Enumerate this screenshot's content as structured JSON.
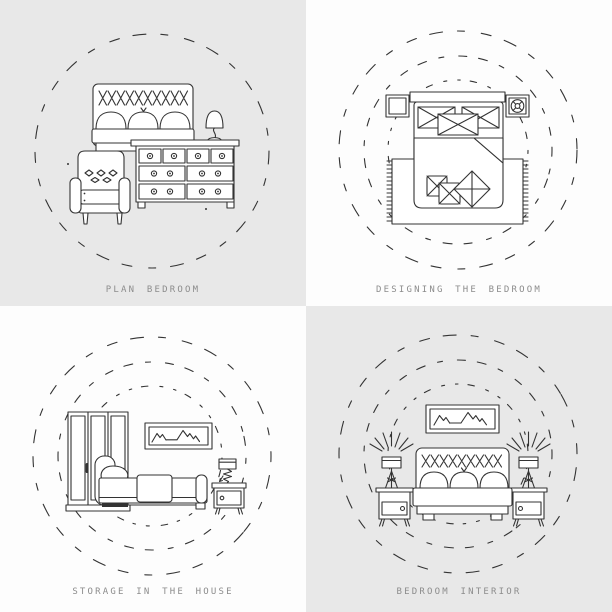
{
  "palette": {
    "quadrant_gray": "#e8e8e8",
    "quadrant_white": "#fdfdfd",
    "line_color": "#333333",
    "caption_color": "#8c8c8c"
  },
  "panels": [
    {
      "caption": "PLAN BEDROOM",
      "background": "gray",
      "dashed_circles": 1,
      "icons": [
        "double-bed-icon",
        "tufted-headboard-icon",
        "pillow-icon",
        "armchair-icon",
        "dresser-icon",
        "table-lamp-icon"
      ]
    },
    {
      "caption": "DESIGNING THE BEDROOM",
      "background": "white",
      "dashed_circles": 3,
      "icons": [
        "bed-top-view-icon",
        "headboard-bar-icon",
        "bedside-table-icon",
        "plant-on-table-icon",
        "folded-blanket-icon",
        "rug-with-fringe-icon",
        "throw-pillow-icon"
      ]
    },
    {
      "caption": "STORAGE IN THE HOUSE",
      "background": "white",
      "dashed_circles": 3,
      "icons": [
        "wardrobe-icon",
        "single-bed-icon",
        "mountain-picture-frame-icon",
        "nightstand-icon",
        "spring-lamp-icon"
      ]
    },
    {
      "caption": "BEDROOM INTERIOR",
      "background": "gray",
      "dashed_circles": 3,
      "icons": [
        "double-bed-icon",
        "tufted-headboard-icon",
        "mountain-picture-frame-icon",
        "nightstand-icon",
        "table-lamp-icon",
        "light-rays-icon"
      ]
    }
  ]
}
